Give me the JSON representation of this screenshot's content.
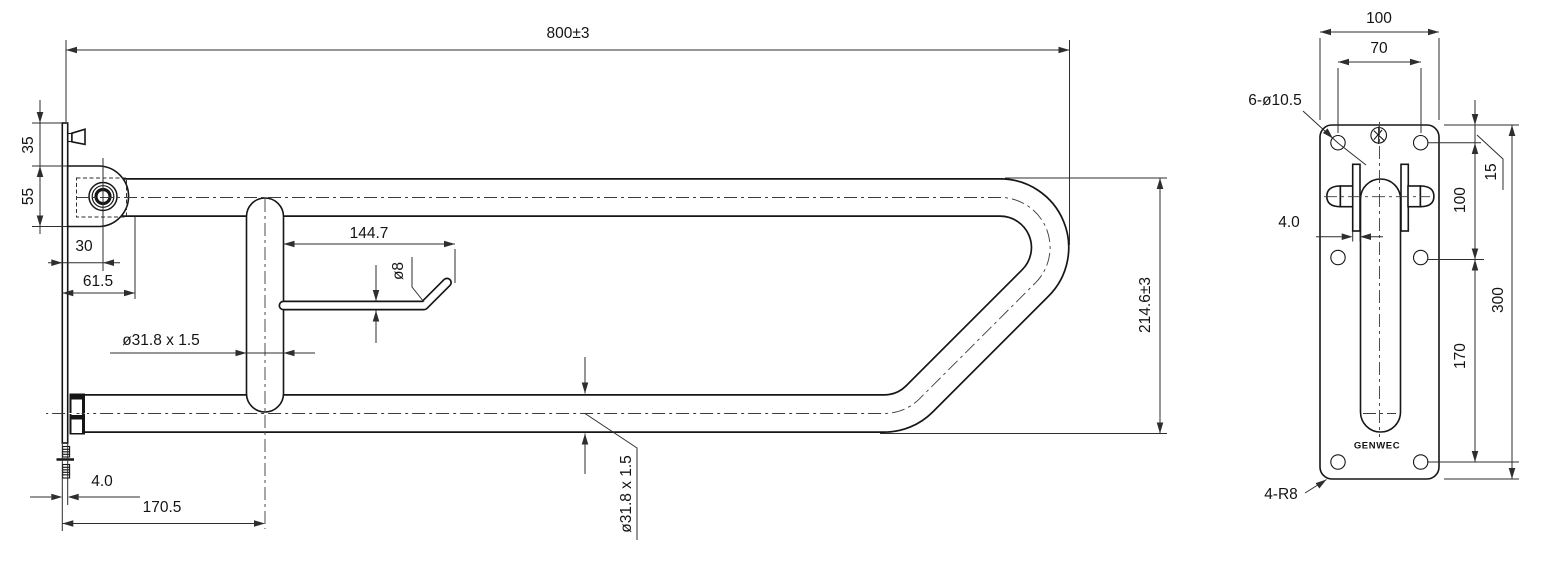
{
  "drawing": {
    "description": "Technical dimension drawing of a fold-up grab rail with toilet paper holder and wall mounting plate",
    "line_color": "#161616",
    "dim_color": "#2e2e2e",
    "background": "#ffffff"
  },
  "main_view": {
    "overall_length": "800±3",
    "overall_height": "214.6±3",
    "dim_35": "35",
    "dim_55": "55",
    "dim_30": "30",
    "dim_61_5": "61.5",
    "tube_spec": "ø31.8 x 1.5",
    "tube_spec_vertical": "ø31.8 x 1.5",
    "paper_rod_length": "144.7",
    "paper_rod_diameter": "ø8",
    "wall_plate_thickness": "4.0",
    "post_offset": "170.5"
  },
  "side_view": {
    "plate_width": "100",
    "hole_spacing_x": "70",
    "holes": "6-ø10.5",
    "top_hole_offset": "15",
    "hole_spacing_y1": "100",
    "hinge_plate_thickness": "4.0",
    "hole_spacing_y2": "170",
    "plate_height": "300",
    "corner_radius": "4-R8",
    "brand": "GENWEC"
  }
}
